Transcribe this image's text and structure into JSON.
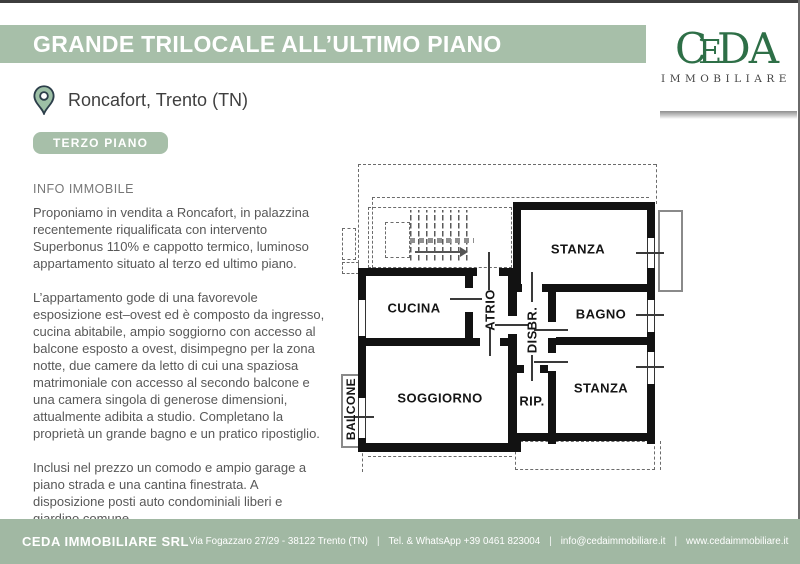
{
  "header": {
    "title": "GRANDE TRILOCALE ALL’ULTIMO PIANO",
    "location": "Roncafort, Trento (TN)",
    "floor_badge": "TERZO PIANO"
  },
  "logo": {
    "letters": {
      "c": "C",
      "e": "E",
      "d": "D",
      "a": "A"
    },
    "subtitle": "IMMOBILIARE"
  },
  "info": {
    "heading": "INFO IMMOBILE",
    "paragraphs": [
      "Proponiamo in vendita a Roncafort, in palazzina recentemente riqualificata con intervento Superbonus 110% e cappotto termico, luminoso appartamento situato al terzo ed ultimo piano.",
      "L’appartamento gode di una favorevole esposizione est–ovest ed è composto da ingresso, cucina abitabile, ampio soggiorno con accesso al balcone esposto a ovest, disimpegno per la zona notte, due camere da letto di cui una spaziosa matrimoniale con accesso al secondo balcone e una camera singola di generose dimensioni, attualmente adibita a studio. Completano la proprietà un grande bagno e un pratico ripostiglio.",
      "Inclusi nel prezzo un comodo e ampio garage a piano strada e una cantina finestrata. A disposizione posti auto condominiali liberi e giardino comune."
    ]
  },
  "floorplan": {
    "rooms": {
      "stanza_top": "STANZA",
      "cucina": "CUCINA",
      "atrio": "ATRIO",
      "disbr": "DISBR.",
      "bagno": "BAGNO",
      "soggiorno": "SOGGIORNO",
      "rip": "RIP.",
      "stanza_bottom": "STANZA",
      "balcone": "BALCONE"
    }
  },
  "footer": {
    "company": "CEDA IMMOBILIARE SRL",
    "address": "Via Fogazzaro 27/29 - 38122 Trento (TN)",
    "phone": "Tel. & WhatsApp +39 0461 823004",
    "email": "info@cedaimmobiliare.it",
    "website": "www.cedaimmobiliare.it",
    "separator": "|"
  },
  "colors": {
    "sage_green": "#a7bfa9",
    "footer_green": "#a1b8a3",
    "logo_green": "#2e6f47",
    "wall_black": "#121212",
    "body_text": "#585858"
  }
}
